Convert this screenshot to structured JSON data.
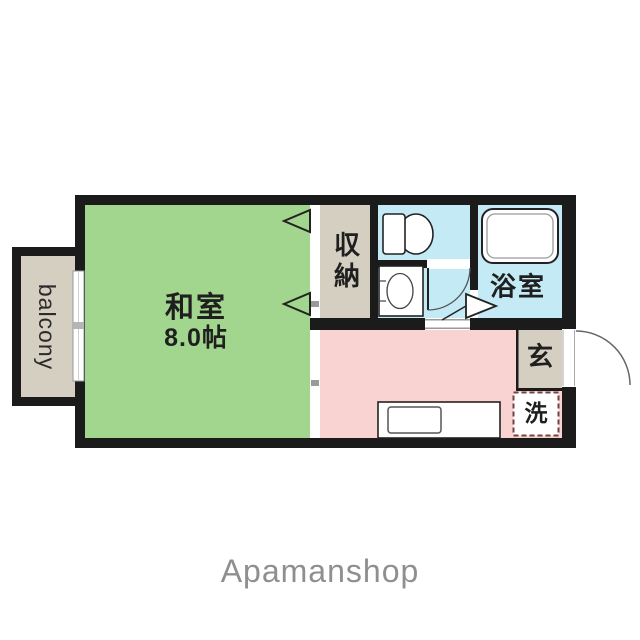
{
  "rooms": {
    "washitsu_name": "和室",
    "washitsu_size": "8.0帖",
    "closet": "収納",
    "bathroom": "浴室",
    "entrance": "玄",
    "laundry": "洗",
    "balcony": "balcony"
  },
  "footer": {
    "brand": "Apamanshop"
  },
  "colors": {
    "wall": "#1b1b1b",
    "tatami": "#a2d68e",
    "wet_area": "#c3eaf5",
    "kitchen": "#f9d3d1",
    "storage": "#d5cfc1",
    "laundry_border": "#6e4444",
    "brand_text": "#8f8f8f",
    "fixture_white": "#ffffff"
  }
}
